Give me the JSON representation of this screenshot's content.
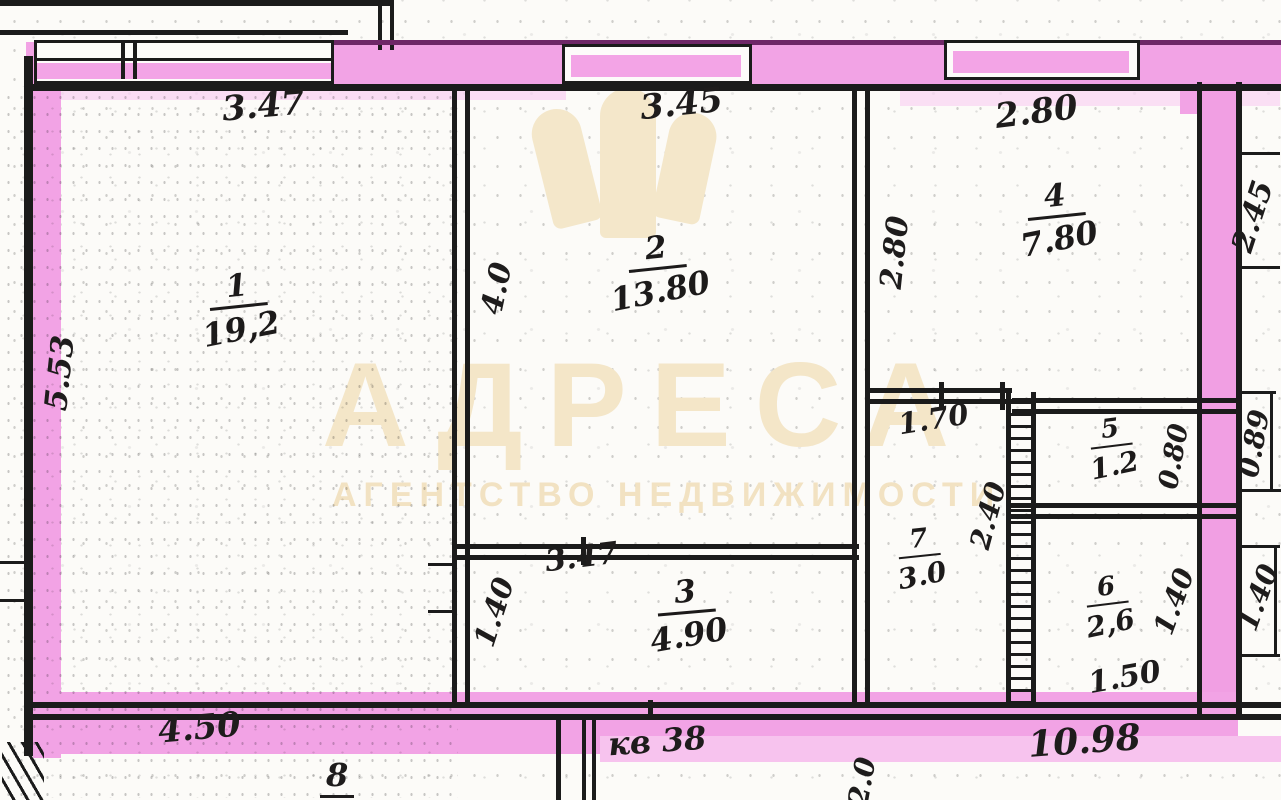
{
  "watermark": {
    "brand": "АДРЕСА",
    "subtitle": "АГЕНТСТВО НЕДВИЖИМОСТИ"
  },
  "apartment_note": "кв 38",
  "rooms": [
    {
      "number": "1",
      "area": "19,2"
    },
    {
      "number": "2",
      "area": "13.80"
    },
    {
      "number": "3",
      "area": "4.90"
    },
    {
      "number": "4",
      "area": "7.80"
    },
    {
      "number": "5",
      "area": "1.2"
    },
    {
      "number": "6",
      "area": "2,6"
    },
    {
      "number": "7",
      "area": "3.0"
    }
  ],
  "dimensions": {
    "top_left": "3.47",
    "top_mid": "3.45",
    "top_right": "2.80",
    "left_height": "5.53",
    "room2_height": "4.0",
    "room4_left": "2.80",
    "right_top": "2.45",
    "opening": "1.70",
    "room5_width": "0.80",
    "right_mid": "0.89",
    "room7_height": "2.40",
    "room3_width": "3.47",
    "room3_height": "1.40",
    "room6_height": "1.40",
    "right_lower": "1.40",
    "room6_width": "1.50",
    "bottom_left": "4.50",
    "bottom_mark": "8",
    "bottom_partial": "2.0",
    "bottom_right": "10.98"
  },
  "colors": {
    "highlighter_pink": "#f2a3e5",
    "highlighter_pink_light": "#f7c3ee",
    "ink": "#1b1b1b",
    "watermark_beige": "#f4e6c8"
  }
}
